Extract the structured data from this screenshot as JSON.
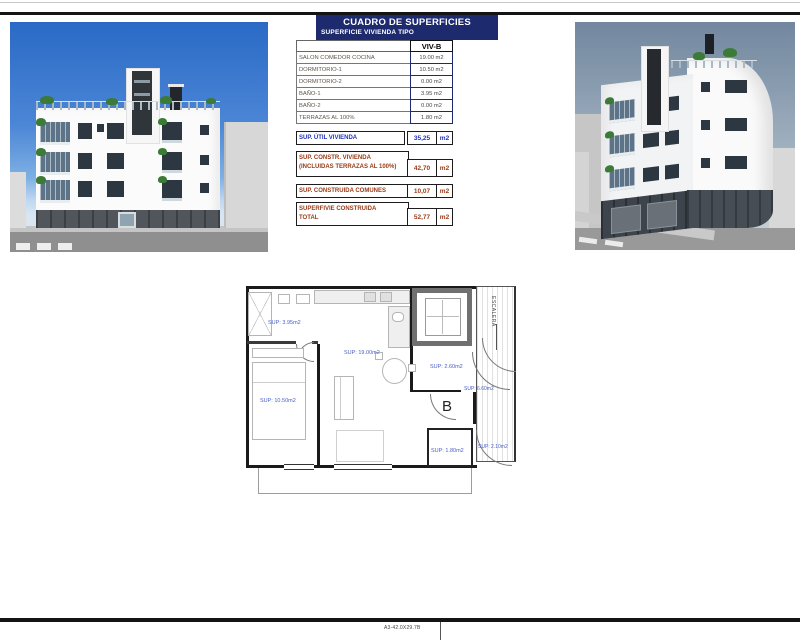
{
  "page": {
    "bottom_note": "A3-42.0X29.7B"
  },
  "colors": {
    "header_navy": "#1d2b6e",
    "accent_blue": "#2233bb",
    "accent_brown": "#9a3b16",
    "plan_label_blue": "#4a5ec4",
    "sky_left": "#2a6ac6",
    "sky_right": "#72879f"
  },
  "surfaces_table": {
    "title": "CUADRO DE SUPERFICIES",
    "subtitle": "SUPERFICIE VIVIENDA TIPO",
    "column_header": "VIV-B",
    "rows": [
      {
        "label": "SALON COMEDOR COCINA",
        "value": "19.00 m2"
      },
      {
        "label": "DORMITORIO-1",
        "value": "10.50 m2"
      },
      {
        "label": "DORMITORIO-2",
        "value": "0.00 m2"
      },
      {
        "label": "BAÑO-1",
        "value": "3.95 m2"
      },
      {
        "label": "BAÑO-2",
        "value": "0.00 m2"
      },
      {
        "label": "TERRAZAS AL 100%",
        "value": "1.80 m2"
      }
    ],
    "summary": [
      {
        "lines": [
          "SUP. ÚTIL VIVIENDA",
          ""
        ],
        "value": "35,25",
        "unit": "m2",
        "style": "blue"
      },
      {
        "lines": [
          "SUP. CONSTR. VIVIENDA",
          "(INCLUIDAS TERRAZAS AL 100%)"
        ],
        "value": "42,70",
        "unit": "m2",
        "style": "brown"
      },
      {
        "lines": [
          "SUP. CONSTRUIDA COMUNES",
          ""
        ],
        "value": "10,07",
        "unit": "m2",
        "style": "brown"
      },
      {
        "lines": [
          "SUPERFIVIE CONSTRUIDA",
          "TOTAL"
        ],
        "value": "52,77",
        "unit": "m2",
        "style": "brown"
      }
    ]
  },
  "floorplan": {
    "unit_label": "B",
    "stairs_label": "ESCALERA",
    "room_labels": {
      "bathroom": "SUP: 3.95m2",
      "living_kitchen": "SUP: 19.00m2",
      "bedroom": "SUP: 10.50m2",
      "hall": "SUP: 2.60m2",
      "common": "SUP: 6.60m2",
      "terrace": "SUP: 1.80m2",
      "terrace_2": "SUP: 2.10m2"
    }
  }
}
